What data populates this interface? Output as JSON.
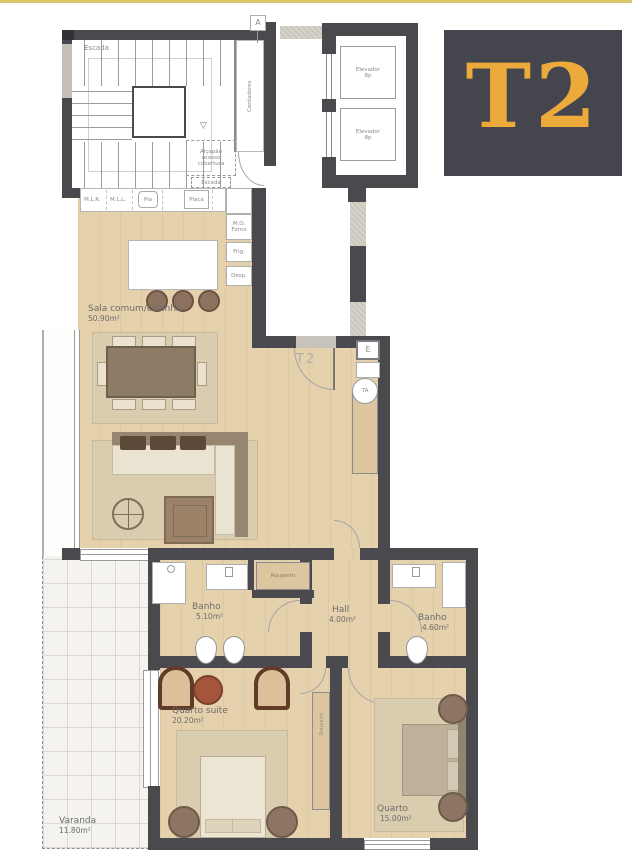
{
  "badge": {
    "text": "T2"
  },
  "top_marker": "A",
  "stairwell": {
    "name": "Escada",
    "arrow": "▽"
  },
  "meters_closet": "Contadores",
  "roof_hatch": {
    "line1": "Alçapão",
    "line2": "acesso",
    "line3": "cobertura",
    "sub": "Escada"
  },
  "elevators": {
    "name": "Elevador",
    "capacity": "8p"
  },
  "kitchen": {
    "counter": [
      "M.L.R.",
      "M.L.L.",
      "Pia",
      "Placa"
    ],
    "appliances": [
      "M.O. Forno",
      "Frig.",
      "Desp."
    ]
  },
  "entry": {
    "floor_tag": "T2",
    "electrical": "E",
    "ta": "TA"
  },
  "rooms": {
    "living": {
      "name": "Sala comum/cozinha",
      "area": "50.90m²"
    },
    "bath1": {
      "name": "Banho",
      "area": "5.10m²"
    },
    "hall": {
      "name": "Hall",
      "area": "4.00m²"
    },
    "bath2": {
      "name": "Banho",
      "area": "4.60m²"
    },
    "suite": {
      "name": "Quarto suite",
      "area": "20.20m²"
    },
    "bedroom": {
      "name": "Quarto",
      "area": "15.00m²"
    },
    "balcony": {
      "name": "Varanda",
      "area": "11.80m²"
    }
  },
  "closets": {
    "hall_wardrobe": "Roupeiro",
    "suite_wardrobe": "Roupeiro"
  },
  "colors": {
    "accent_gold": "#ECAA3B",
    "badge_bg": "#45454D",
    "wall": "#4A4A4E",
    "wood": "#E6D1AD",
    "top_line": "#D9C56A",
    "terracotta": "#A3563C"
  }
}
